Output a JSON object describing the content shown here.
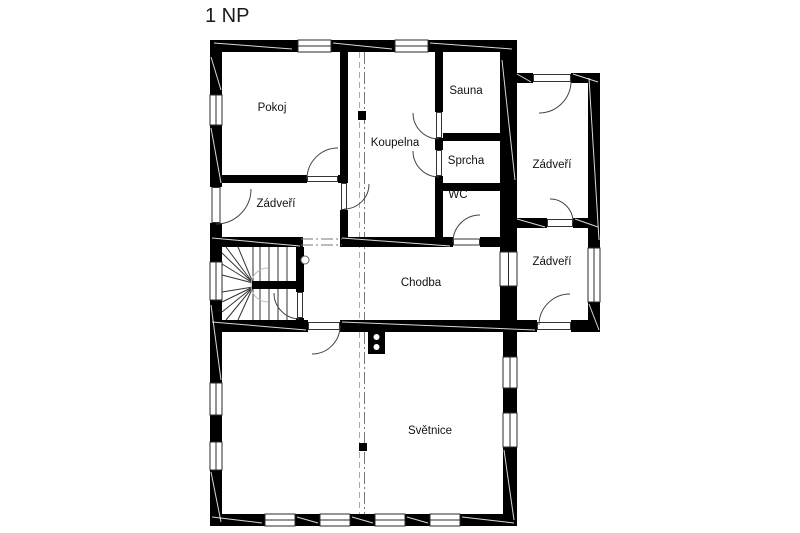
{
  "title": "1 NP",
  "rooms": {
    "pokoj": {
      "label": "Pokoj"
    },
    "koupelna": {
      "label": "Koupelna"
    },
    "sauna": {
      "label": "Sauna"
    },
    "sprcha": {
      "label": "Sprcha"
    },
    "wc": {
      "label": "WC"
    },
    "zadveri_left": {
      "label": "Zádveří"
    },
    "zadveri_upper_right": {
      "label": "Zádveří"
    },
    "zadveri_lower_right": {
      "label": "Zádveří"
    },
    "chodba": {
      "label": "Chodba"
    },
    "svetnice": {
      "label": "Světnice"
    }
  },
  "colors": {
    "wall": "#000000",
    "background": "#ffffff",
    "thin_line": "#333333",
    "section_line": "#888888"
  }
}
